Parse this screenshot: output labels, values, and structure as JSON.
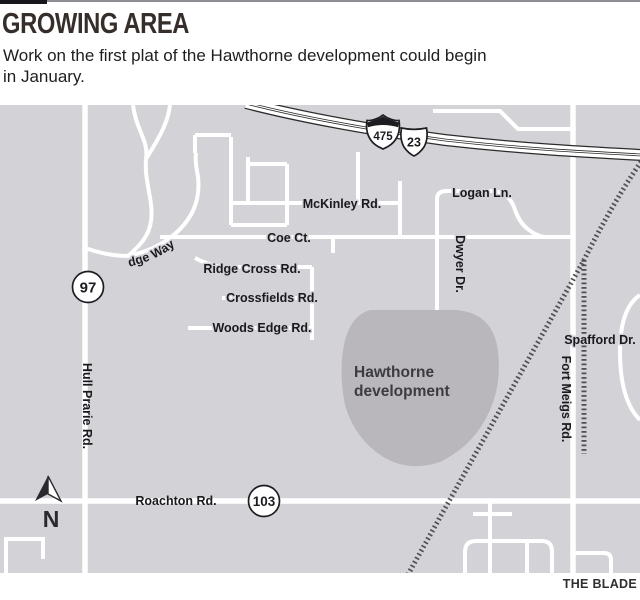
{
  "header": {
    "title": "GROWING AREA",
    "subtitle_line1": "Work on the first plat of the Hawthorne development could begin",
    "subtitle_line2": "in January."
  },
  "credit": "THE BLADE",
  "map": {
    "labels": {
      "mckinley": "McKinley Rd.",
      "logan": "Logan Ln.",
      "coe": "Coe Ct.",
      "ridge_cross": "Ridge Cross Rd.",
      "crossfields": "Crossfields Rd.",
      "woods_edge": "Woods Edge Rd.",
      "river_ridge": "River Ridge Way",
      "dwyer": "Dwyer Dr.",
      "spafford": "Spafford Dr.",
      "fort_meigs": "Fort Meigs Rd.",
      "hull_prarie": "Hull Prarie Rd.",
      "roachton": "Roachton Rd."
    },
    "area": {
      "line1": "Hawthorne",
      "line2": "development"
    },
    "shields": {
      "interstate": "475",
      "us_route": "23",
      "state_left": "97",
      "state_bottom": "103"
    },
    "north_label": "N",
    "colors": {
      "background": "#d3d2d6",
      "road": "#ffffff",
      "development_area": "#b9b7bc",
      "railroad": "#505053",
      "casing": "#2b2b2b",
      "label": "#1a191d",
      "title": "#362e2b"
    }
  }
}
